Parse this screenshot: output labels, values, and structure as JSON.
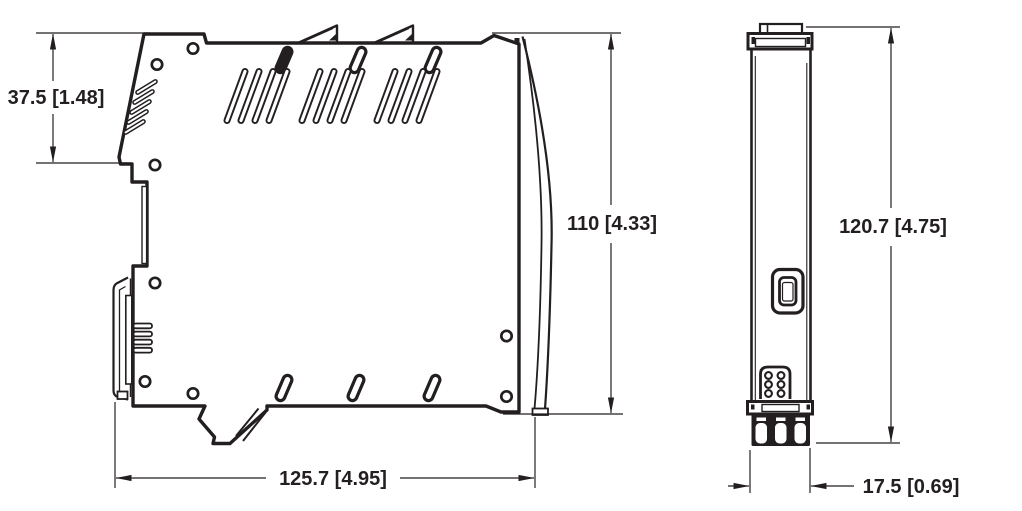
{
  "drawing": {
    "line_color": "#231f20",
    "background_color": "#ffffff",
    "dimensions": {
      "upper_section_height": {
        "label": "37.5 [1.48]",
        "mm": 37.5,
        "inch": 1.48
      },
      "body_height": {
        "label": "110 [4.33]",
        "mm": 110,
        "inch": 4.33
      },
      "overall_depth": {
        "label": "125.7 [4.95]",
        "mm": 125.7,
        "inch": 4.95
      },
      "overall_height": {
        "label": "120.7 [4.75]",
        "mm": 120.7,
        "inch": 4.75
      },
      "module_width": {
        "label": "17.5 [0.69]",
        "mm": 17.5,
        "inch": 0.69
      }
    }
  }
}
